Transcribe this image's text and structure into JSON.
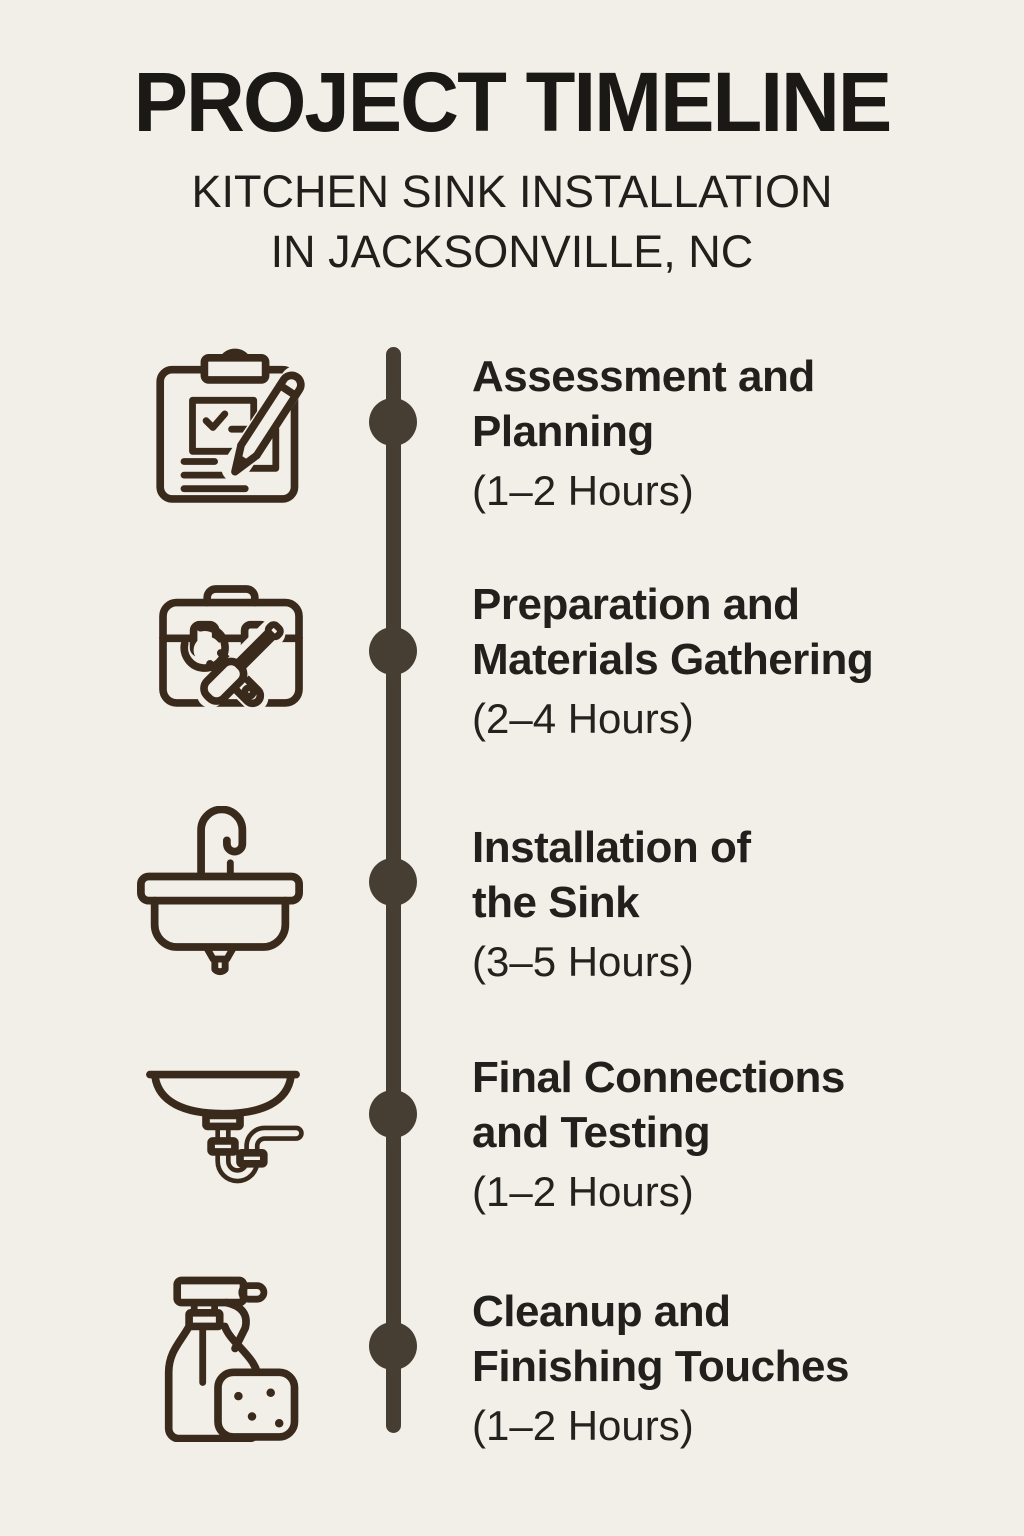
{
  "header": {
    "title": "PROJECT TIMELINE",
    "subtitle_lines": [
      "KITCHEN SINK INSTALLATION",
      "IN JACKSONVILLE, NC"
    ]
  },
  "colors": {
    "background": "#f2efe8",
    "heading_text": "#1b1916",
    "body_text": "#22201c",
    "timeline_spine": "#473e33",
    "icon_stroke": "#3a2a1c"
  },
  "timeline": {
    "items": [
      {
        "icon": "clipboard-pencil-icon",
        "title_lines": [
          "Assessment and",
          "Planning"
        ],
        "duration": "(1–2 Hours)"
      },
      {
        "icon": "toolbox-tools-icon",
        "title_lines": [
          "Preparation and",
          "Materials Gathering"
        ],
        "duration": "(2–4 Hours)"
      },
      {
        "icon": "kitchen-sink-icon",
        "title_lines": [
          "Installation of",
          "the Sink"
        ],
        "duration": "(3–5 Hours)"
      },
      {
        "icon": "drain-pipe-icon",
        "title_lines": [
          "Final Connections",
          "and Testing"
        ],
        "duration": "(1–2 Hours)"
      },
      {
        "icon": "spray-bottle-sponge-icon",
        "title_lines": [
          "Cleanup and",
          "Finishing Touches"
        ],
        "duration": "(1–2 Hours)"
      }
    ]
  }
}
